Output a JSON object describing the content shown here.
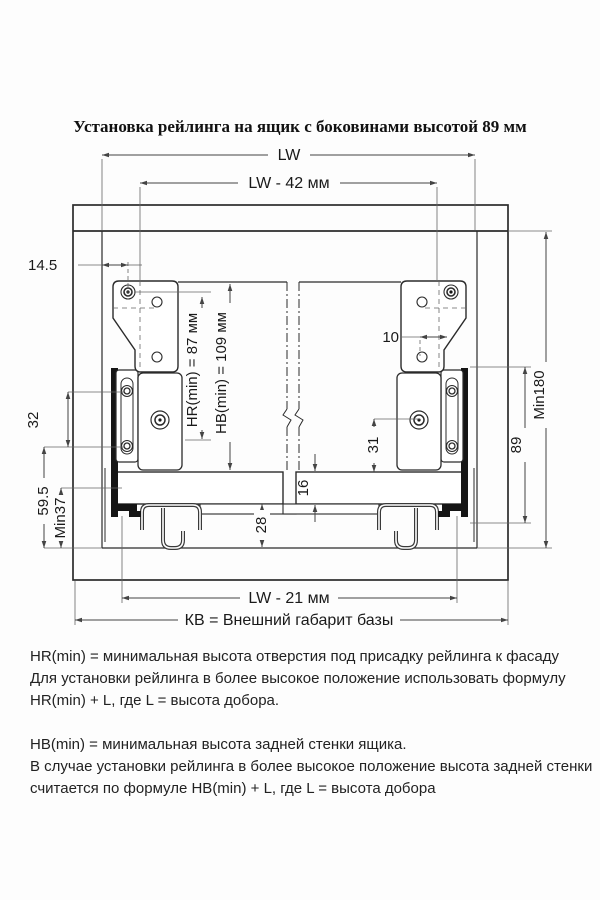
{
  "title": "Установка рейлинга на ящик с боковинами высотой 89 мм",
  "diagram": {
    "dims": {
      "lw": "LW",
      "lw_minus_42": "LW - 42 мм",
      "d14_5": "14.5",
      "hr_min": "HR(min) = 87 мм",
      "hb_min": "HB(min) = 109 мм",
      "d10": "10",
      "min180": "Min180",
      "d32": "32",
      "d31": "31",
      "d89": "89",
      "d16": "16",
      "d59_5": "59.5",
      "min37": "Min37",
      "d28": "28",
      "lw_minus_21": "LW - 21 мм",
      "kb": "КВ = Внешний габарит базы"
    },
    "colors": {
      "line": "#2b2b2b",
      "text": "#1a1a1a",
      "background": "#ffffff"
    }
  },
  "notes": {
    "hr": [
      "HR(min) = минимальная высота отверстия под присадку рейлинга к фасаду",
      "Для установки рейлинга в более высокое положение использовать формулу",
      "HR(min) + L,  где L = высота добора."
    ],
    "hb": [
      "HB(min) = минимальная высота задней стенки ящика.",
      "В случае установки рейлинга в более высокое положение высота задней стенки",
      "считается по формуле HB(min) + L, где L = высота добора"
    ]
  }
}
